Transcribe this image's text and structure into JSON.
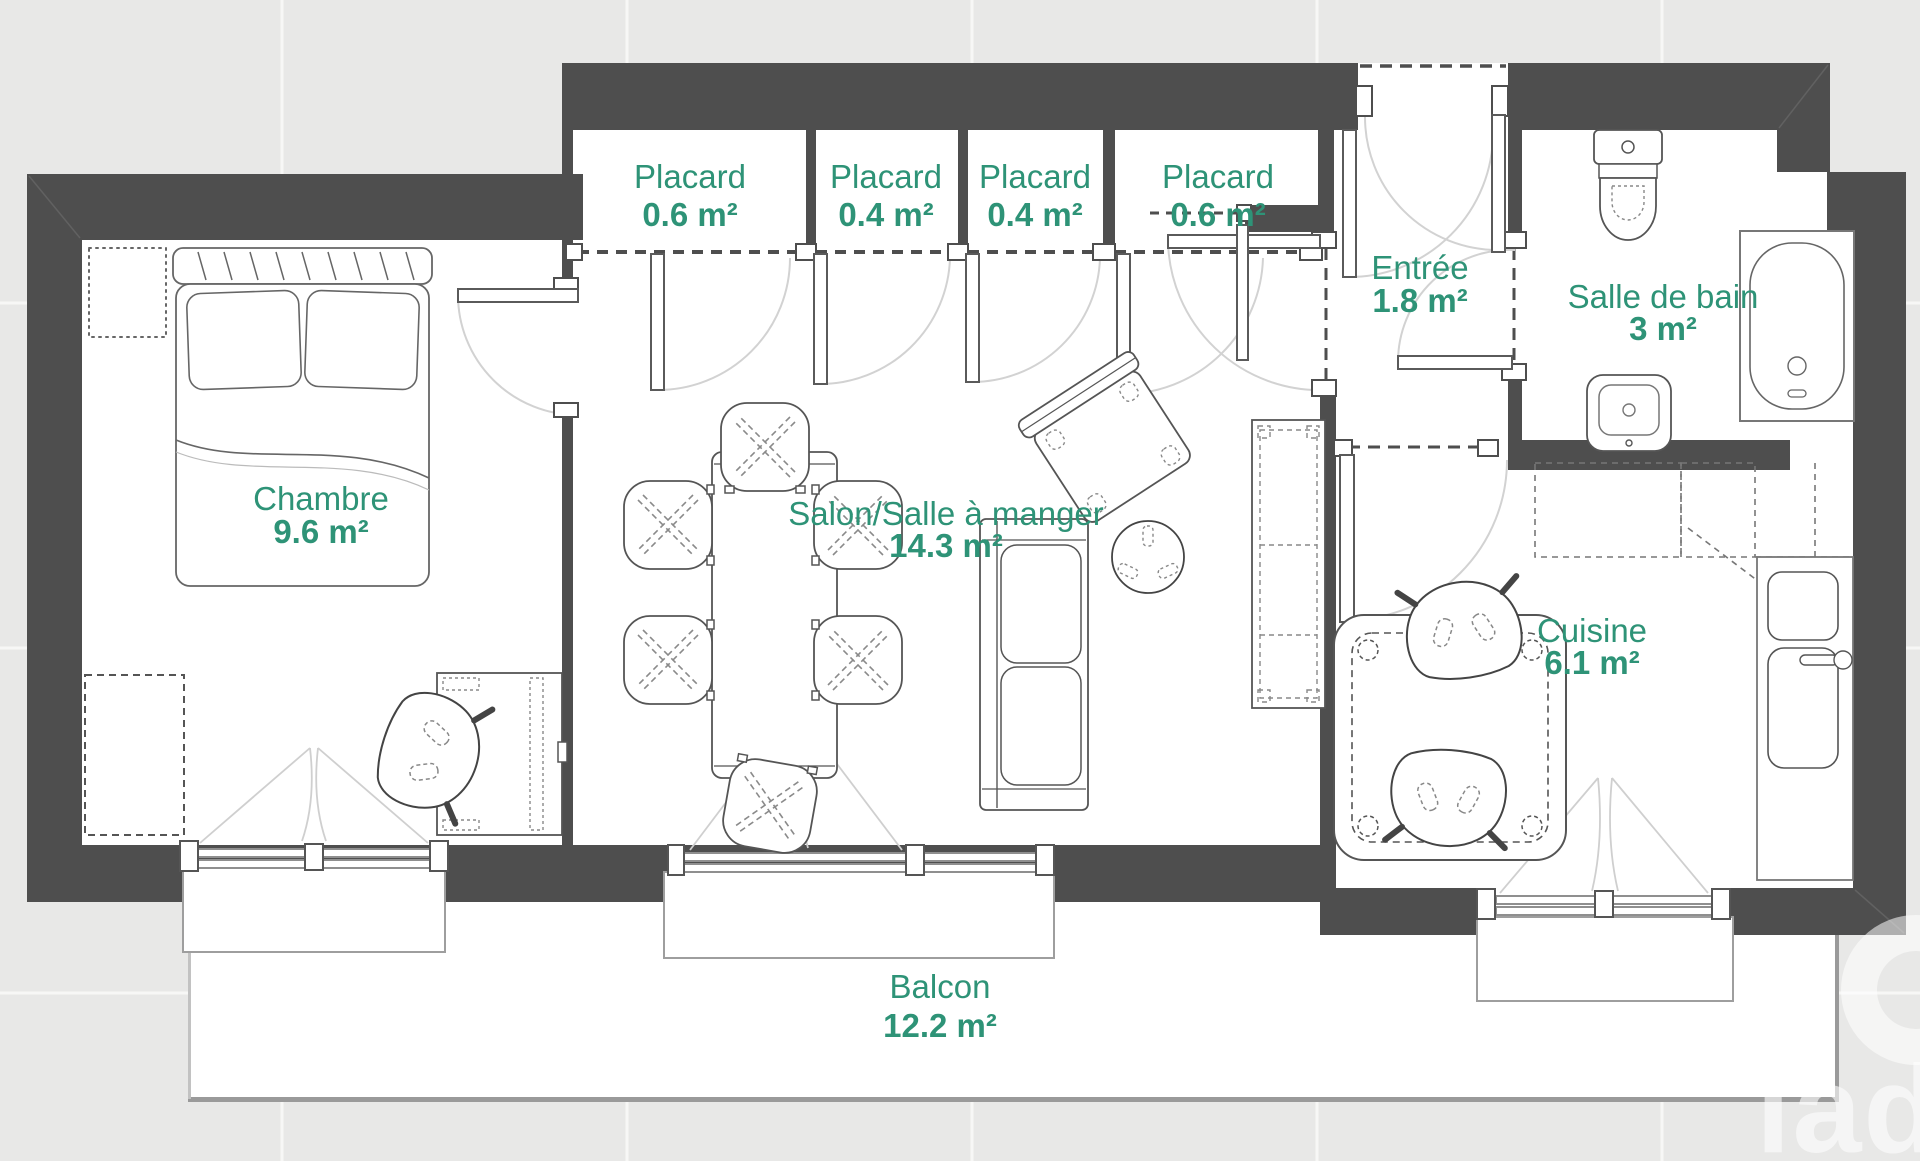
{
  "floorplan": {
    "rooms": [
      {
        "id": "chambre",
        "name": "Chambre",
        "area": "9.6 m²"
      },
      {
        "id": "placard-1",
        "name": "Placard",
        "area": "0.6 m²"
      },
      {
        "id": "placard-2",
        "name": "Placard",
        "area": "0.4 m²"
      },
      {
        "id": "placard-3",
        "name": "Placard",
        "area": "0.4 m²"
      },
      {
        "id": "placard-4",
        "name": "Placard",
        "area": "0.6 m²"
      },
      {
        "id": "salon",
        "name": "Salon/Salle à manger",
        "area": "14.3 m²"
      },
      {
        "id": "entree",
        "name": "Entrée",
        "area": "1.8 m²"
      },
      {
        "id": "salle-de-bain",
        "name": "Salle de bain",
        "area": "3 m²"
      },
      {
        "id": "cuisine",
        "name": "Cuisine",
        "area": "6.1 m²"
      },
      {
        "id": "balcon",
        "name": "Balcon",
        "area": "12.2 m²"
      }
    ],
    "watermark_text": "iad",
    "colors": {
      "label": "#2E9377",
      "wall": "#4E4E4E",
      "background": "#E8E8E7",
      "paper": "#FFFFFF"
    }
  }
}
